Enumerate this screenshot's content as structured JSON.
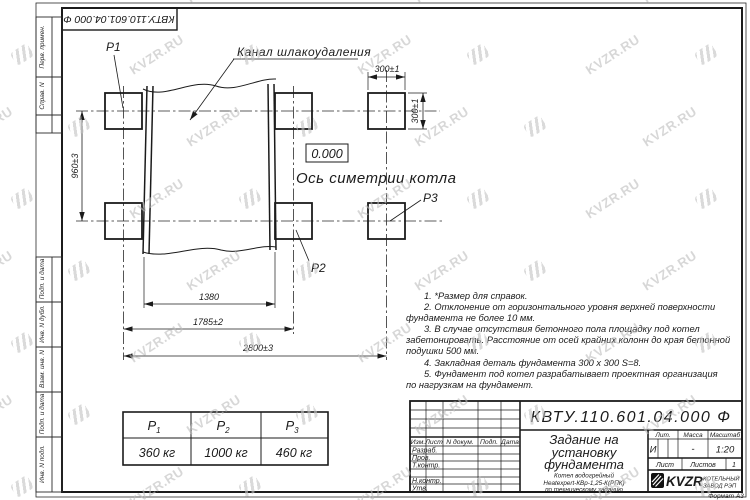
{
  "watermark": {
    "text": "KVZR.RU"
  },
  "top_stamp": {
    "doc_number": "КВТУ.110.601.04.000  Ф"
  },
  "margin": {
    "labels": [
      "Перв. примен.",
      "Справ. N",
      "Подп. и дата",
      "Инв. N дубл.",
      "Взам. инв. N",
      "Подп. и дата",
      "Инв. N подл."
    ]
  },
  "drawing": {
    "p1": "P1",
    "p2": "P2",
    "p3": "P3",
    "channel_label": "Канал шлакоудаления",
    "elevation": "0.000",
    "axis_label": "Ось симетрии котла",
    "dim_960": "960±3",
    "dim_300_h": "300±1",
    "dim_300_v": "300±1",
    "dim_1380": "1380",
    "dim_1785": "1785±2",
    "dim_2800": "2800±3"
  },
  "notes": {
    "lines": [
      "1.  *Размер для справок.",
      "2.  Отклонение от горизонтального уровня верхней поверхности",
      "фундамента не более 10 мм.",
      "3.  В случае отсутствия бетонного пола площадку под котел",
      "забетонировать. Расстояние от осей крайних колонн до края бетонной",
      "подушки 500 мм.",
      "4.  Закладная деталь фундамента  300 x 300 S=8.",
      "5.  Фундамент под котел разрабатывает проектная организация",
      "по нагрузкам на фундамент."
    ]
  },
  "load_table": {
    "headers": [
      {
        "base": "P",
        "sub": "1"
      },
      {
        "base": "P",
        "sub": "2"
      },
      {
        "base": "P",
        "sub": "3"
      }
    ],
    "values": [
      "360 кг",
      "1000 кг",
      "460 кг"
    ]
  },
  "title_block": {
    "doc_number": "КВТУ.110.601.04.000  Ф",
    "title_line1": "Задание на",
    "title_line2": "установку",
    "title_line3": "фундамента",
    "product_line1": "Котел водогрейный",
    "product_line2": "Heatexpert-КВр-1,25-К(РПК)",
    "product_line3": "по техническому заданию",
    "col_izm": "Изм.",
    "col_list": "Лист",
    "col_doc": "N докум.",
    "col_podp": "Подп.",
    "col_data": "Дата",
    "row_razrab": "Разраб.",
    "row_prov": "Пров.",
    "row_tkontr": "Т.контр.",
    "row_nkontr": "Н.контр.",
    "row_utv": "Утв.",
    "lit_header": "Лит.",
    "mass_header": "Масса",
    "scale_header": "Масштаб",
    "lit_value": "И",
    "mass_value": "-",
    "scale_value": "1:20",
    "sheet_label": "Лист",
    "sheets_label": "Листов",
    "sheets_value": "1",
    "logo_text": "KVZR",
    "company_line1": "КОТЕЛЬНЫЙ",
    "company_line2": "ЗАВОД РЭП",
    "format_label": "Формат А3"
  }
}
